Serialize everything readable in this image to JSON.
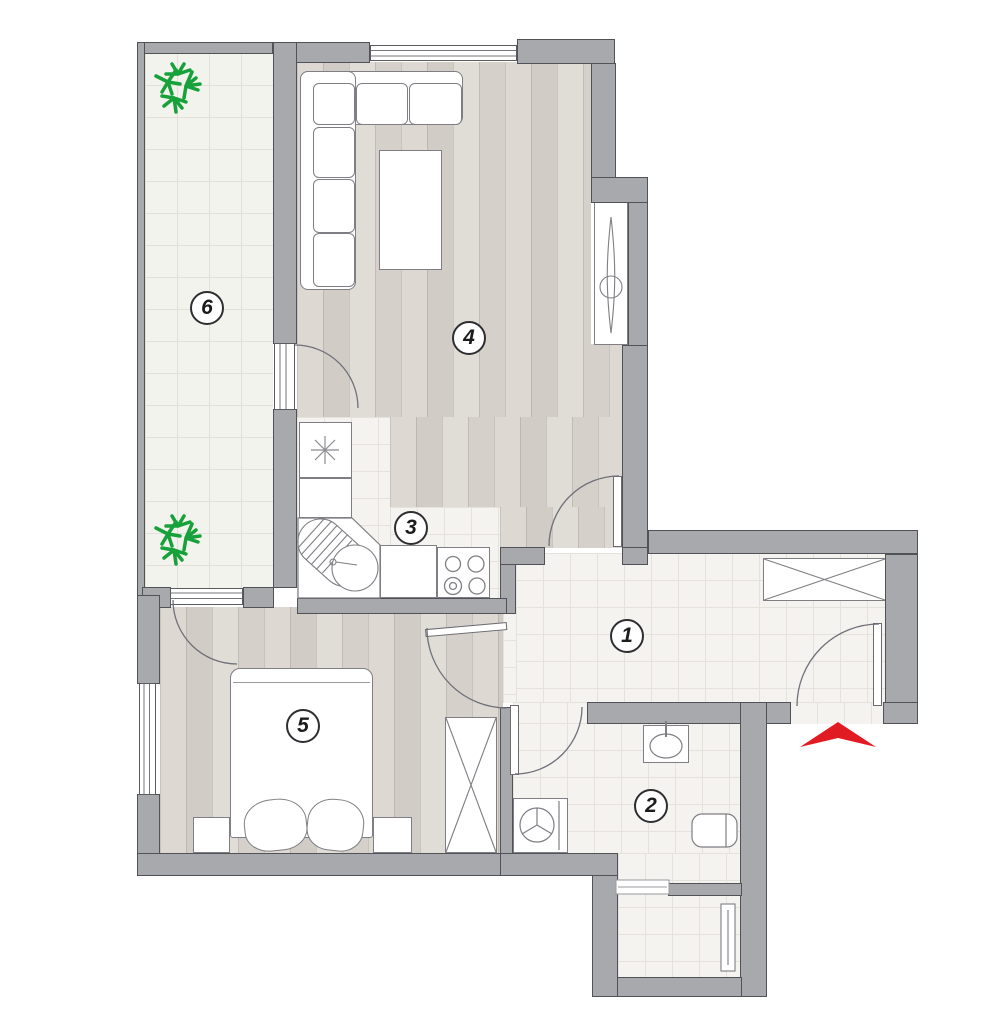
{
  "rooms": [
    {
      "number": "1",
      "floor": "tile"
    },
    {
      "number": "2",
      "floor": "tile"
    },
    {
      "number": "3",
      "floor": "tile"
    },
    {
      "number": "4",
      "floor": "wood"
    },
    {
      "number": "5",
      "floor": "wood"
    },
    {
      "number": "6",
      "floor": "tile"
    }
  ],
  "entrance": {
    "marker": "red-arrow",
    "direction": "up"
  },
  "colors": {
    "wall": "#a7a9ad",
    "wall_outline": "#515257",
    "tile_floor": "#f4f3ef",
    "tile_grid": "#e4e2da",
    "wood_floor": "#d8d3cd",
    "furniture_outline": "#7e7e84",
    "plant": "#16a13a",
    "entrance_arrow": "#e11b22",
    "badge_text": "#1c1c1e"
  }
}
